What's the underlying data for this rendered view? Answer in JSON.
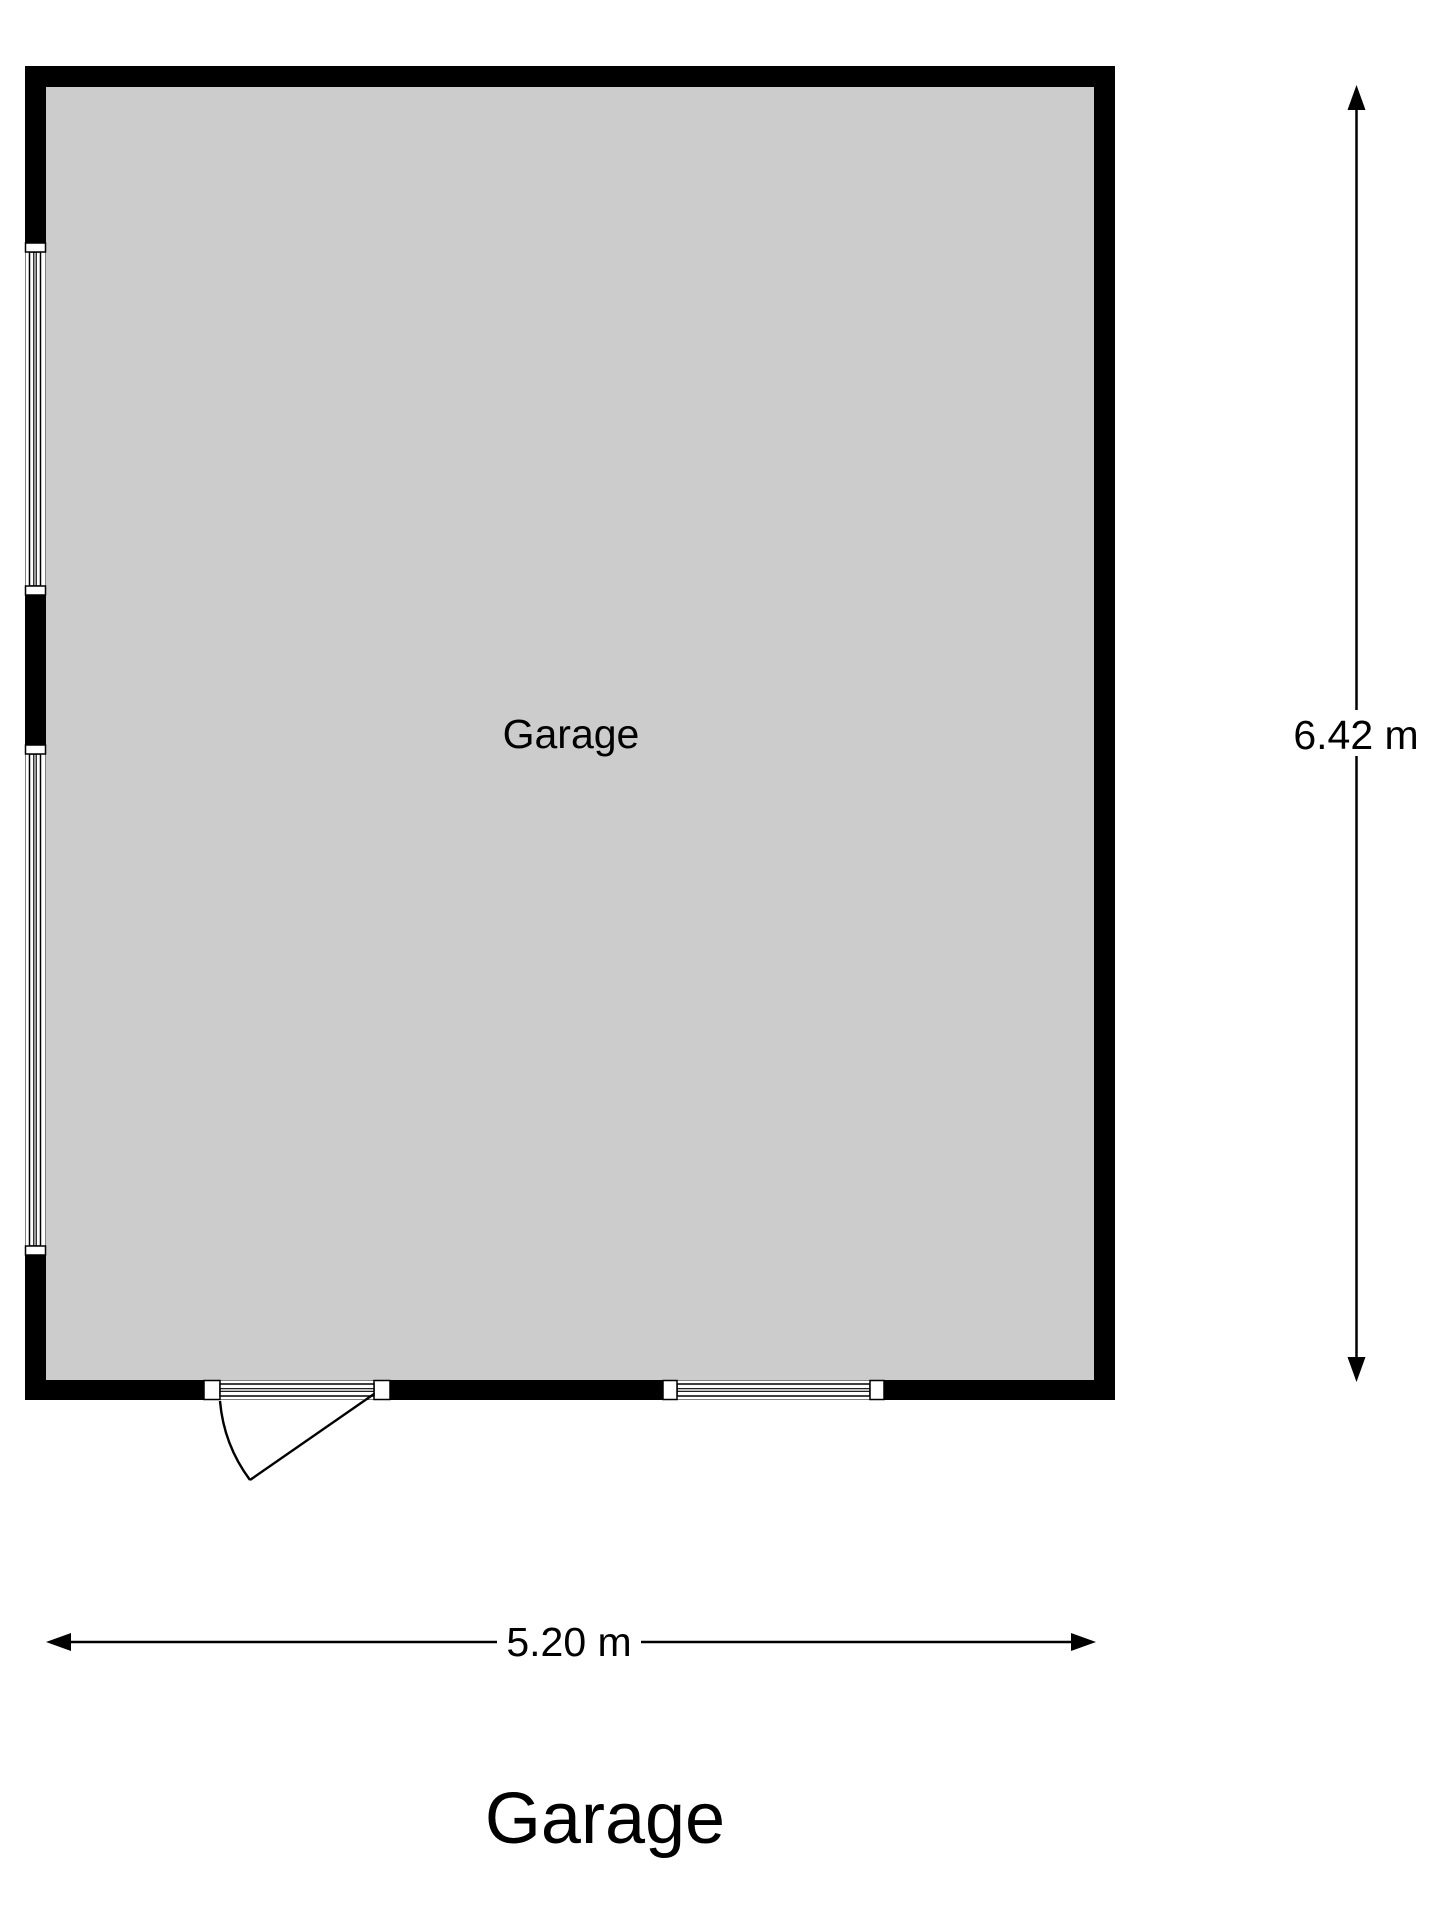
{
  "floorplan": {
    "room_label": "Garage",
    "title": "Garage",
    "dimensions": {
      "height": "6.42 m",
      "width": "5.20 m"
    },
    "colors": {
      "wall": "#000000",
      "floor": "#cccccc",
      "background": "#ffffff",
      "text": "#000000"
    }
  }
}
